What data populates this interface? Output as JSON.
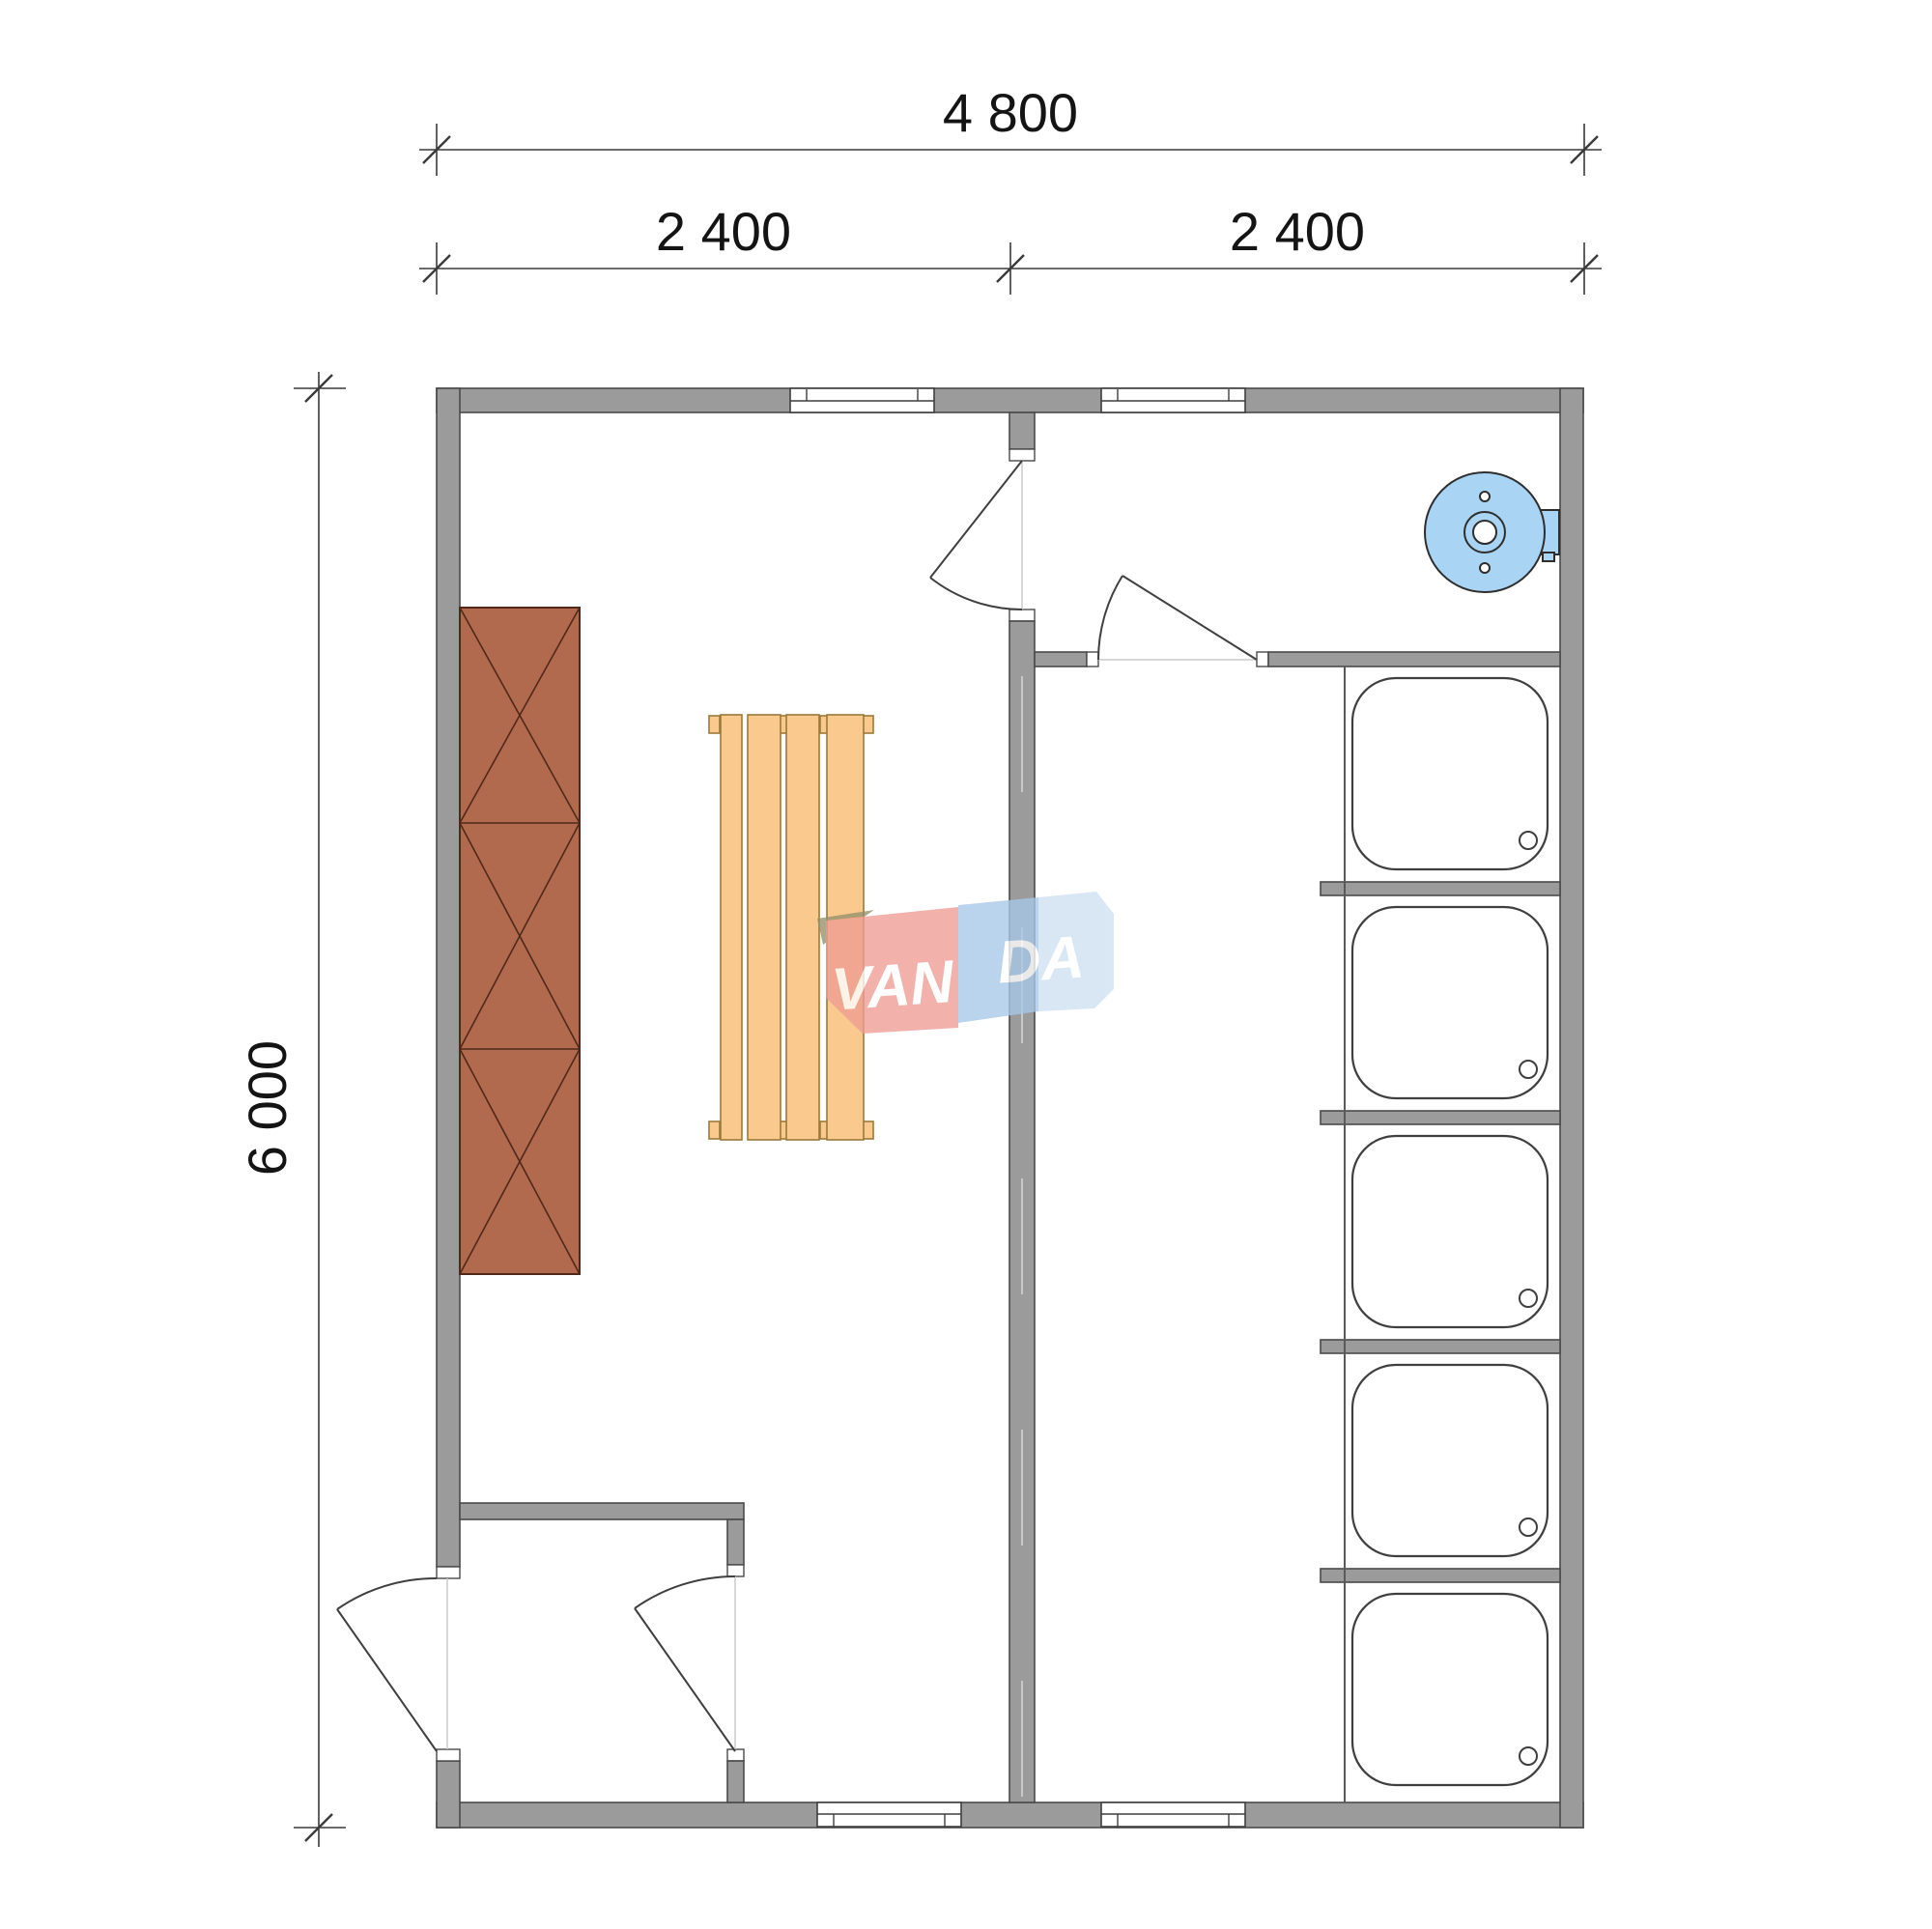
{
  "document": {
    "type": "architectural floor plan",
    "units": "mm"
  },
  "dimensions": {
    "top_total": "4 800",
    "top_bay_left": "2 400",
    "top_bay_right": "2 400",
    "side_total": "6 000"
  },
  "watermark": {
    "left": "VAN",
    "right": "DA",
    "full": "VANDA"
  },
  "fixtures": {
    "shower_trays": 5,
    "bench_boards": 4,
    "cabinet_sections": 3,
    "windows": 4,
    "doors": 4,
    "water_heaters": 1
  },
  "palette": {
    "wall": "#9b9b9b",
    "wall_edge": "#4a4a4a",
    "wall_centerline": "#c9c9c9",
    "line": "#3f3f3f",
    "dim": "#3a3a3a",
    "heater": "#a9d4f4",
    "bench": "#f9c98e",
    "bench_edge": "#9b7a3a",
    "cabinet": "#b26a4e",
    "cabinet_edge": "#50281a",
    "logo_red": "#ef9d94",
    "logo_blue_mid": "#a9c8e8",
    "logo_blue_light": "#cfe0f2",
    "logo_olive": "#95906c"
  }
}
